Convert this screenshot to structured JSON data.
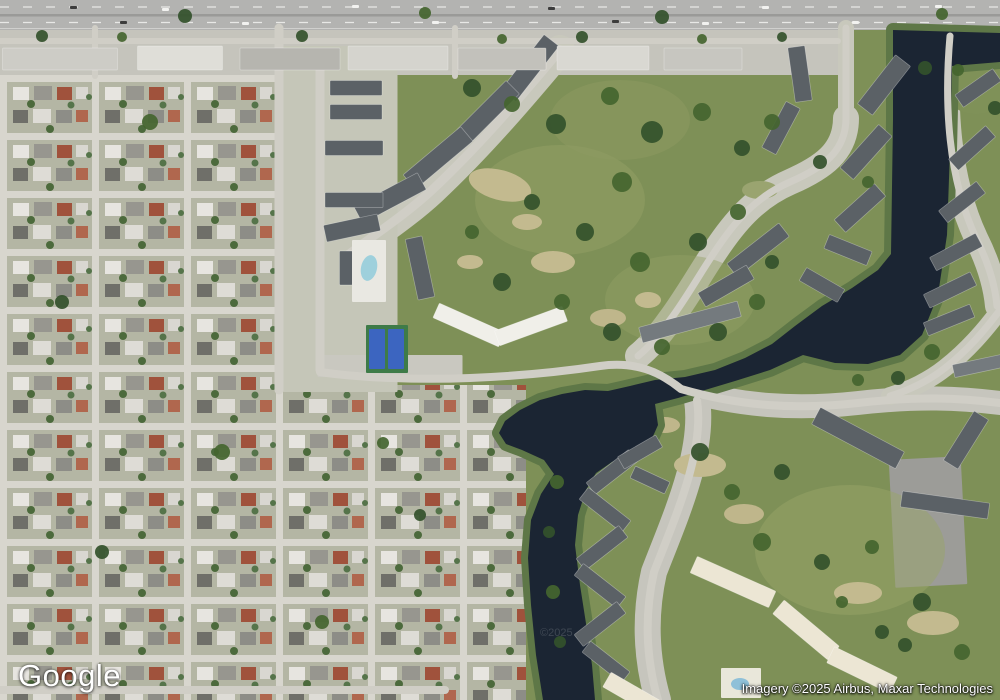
{
  "map": {
    "view_type": "satellite",
    "logo": "Google",
    "attribution": "Imagery ©2025 Airbus, Maxar Technologies",
    "watermark": "©2025"
  },
  "palette": {
    "water": "#1b2533",
    "bank": "#5e7747",
    "green": "#7e9057",
    "suburb_lawn": "#b4b6a4",
    "street": "#d8d6ce",
    "road": "#d0cec6",
    "ground": "#c8c8bc",
    "highway": "#b3b3b1",
    "parking": "#9c9c98",
    "tan_patch": "#c3ba8f",
    "court_green": "#3e7b48",
    "court_blue": "#3c65c0",
    "pool_blue": "#9ed0dc",
    "tree1": "#33512b",
    "tree2": "#44652f",
    "roofs": {
      "dark": "#5b6166",
      "mid": "#747a7e",
      "cream": "#ece6d4",
      "white": "#f0efe9",
      "light": "#cfcec8"
    }
  },
  "features": {
    "water_path": "M893,30 L1000,33 L1000,62 L952,66 L950,150 L947,235 L938,295 L922,335 L900,355 L868,364 L835,363 L803,355 L770,370 L735,381 L705,390 L678,398 L655,404 L658,425 L650,443 L632,453 L612,462 L596,473 L586,490 L578,515 L575,545 L580,585 L587,630 L592,665 L595,700 L543,700 L536,655 L531,605 L528,558 L531,520 L541,494 L554,474 L544,460 L522,450 L506,444 L499,433 L505,421 L520,410 L540,400 L562,394 L585,390 L608,391 L630,386 L655,380 L685,377 L715,370 L745,358 L772,344 L795,326 L822,306 L852,288 L878,270 L891,254 L893,120 Z",
    "ground_paths": [
      [
        "M560,50 C525,92 480,145 432,190 C404,216 372,236 344,258",
        30,
        "#c8c8bc"
      ],
      [
        "M846,28 L846,118",
        16,
        "#c8c8bc"
      ],
      [
        "M846,118 C846,152 822,168 790,182 C758,196 738,218 720,244 C703,268 688,296 670,320 C658,337 648,348 638,356",
        26,
        "#c8c8bc"
      ],
      [
        "M950,36 C944,104 948,178 976,238 C988,262 995,284 997,306",
        24,
        "#c8c8bc"
      ],
      [
        "M681,389 C740,406 795,410 858,403 C918,396 960,398 1000,403",
        24,
        "#c6c5bd"
      ],
      [
        "M697,400 C705,452 674,520 654,572 C645,612 645,655 658,700",
        26,
        "#c6c5bd"
      ],
      [
        "M1000,310 C985,330 968,350 945,368 C930,380 910,390 890,396",
        18,
        "#c8c8bc"
      ]
    ],
    "ground_rects": [
      [
        340,
        219,
        115,
        346,
        0,
        "#c5c6b8"
      ],
      [
        928,
        522,
        72,
        128,
        -3,
        "#9c9c98"
      ],
      [
        390,
        366,
        145,
        22,
        0,
        "#c9c8c0"
      ]
    ],
    "ground_ellipses": [
      [
        976,
        86,
        34,
        28,
        0,
        "#7f9158",
        1
      ],
      [
        560,
        200,
        85,
        55,
        0,
        "#93a065",
        0.5
      ],
      [
        680,
        300,
        75,
        45,
        0,
        "#93a065",
        0.45
      ],
      [
        850,
        550,
        95,
        65,
        0,
        "#98a468",
        0.5
      ],
      [
        620,
        120,
        70,
        40,
        0,
        "#8d9a62",
        0.5
      ],
      [
        500,
        185,
        32,
        15,
        15,
        "#c3ba8f",
        1
      ],
      [
        553,
        262,
        22,
        11,
        0,
        "#c3ba8f",
        1
      ],
      [
        608,
        318,
        18,
        9,
        0,
        "#bfb68b",
        1
      ],
      [
        648,
        300,
        13,
        8,
        0,
        "#c3ba8f",
        1
      ],
      [
        700,
        465,
        26,
        12,
        0,
        "#c3ba8f",
        1
      ],
      [
        744,
        514,
        20,
        10,
        0,
        "#bfb68b",
        1
      ],
      [
        858,
        593,
        24,
        11,
        0,
        "#c3ba8f",
        1
      ],
      [
        933,
        623,
        26,
        12,
        0,
        "#c3ba8f",
        1
      ],
      [
        665,
        425,
        15,
        8,
        0,
        "#bfb68b",
        1
      ],
      [
        470,
        262,
        13,
        7,
        0,
        "#c3ba8f",
        1
      ],
      [
        527,
        222,
        15,
        8,
        0,
        "#c3ba8f",
        1
      ],
      [
        760,
        190,
        18,
        9,
        0,
        "#9aa470",
        1
      ]
    ],
    "roads": [
      [
        "M0,41 L838,41",
        6
      ],
      [
        "M279,28 L279,390",
        9
      ],
      [
        "M95,28 L95,76",
        6
      ],
      [
        "M455,28 L455,76",
        6
      ],
      [
        "M846,28 L846,118",
        7
      ],
      [
        "M846,118 C846,152 822,168 790,182 C758,196 738,218 720,244 C703,268 688,296 670,320 C658,337 648,348 638,356",
        7
      ],
      [
        "M950,36 C944,104 948,178 976,238 C988,262 995,284 997,306",
        7
      ],
      [
        "M320,60 L320,370",
        9
      ],
      [
        "M560,50 C525,92 480,145 432,190 C404,216 372,236 344,258",
        9
      ],
      [
        "M320,372 C360,378 420,380 470,378 C520,376 560,372 600,366 C636,361 660,372 681,389",
        8
      ],
      [
        "M681,389 C740,406 795,410 858,403 C918,396 960,398 1000,403",
        8
      ],
      [
        "M697,400 C705,452 674,520 654,572 C645,612 645,655 658,700",
        8
      ],
      [
        "M1000,310 C985,330 968,350 945,368 C930,380 910,390 890,396",
        7
      ],
      [
        "M0,690 L445,690",
        8
      ]
    ],
    "buildings": [
      [
        530,
        68,
        70,
        19,
        -52,
        "dark"
      ],
      [
        488,
        112,
        70,
        19,
        -45,
        "dark"
      ],
      [
        438,
        158,
        75,
        19,
        -40,
        "dark"
      ],
      [
        390,
        198,
        72,
        19,
        -28,
        "dark"
      ],
      [
        352,
        228,
        55,
        17,
        -12,
        "dark"
      ],
      [
        356,
        88,
        52,
        15,
        0,
        "dark"
      ],
      [
        356,
        112,
        52,
        15,
        0,
        "dark"
      ],
      [
        354,
        148,
        58,
        15,
        0,
        "dark"
      ],
      [
        354,
        200,
        58,
        15,
        0,
        "dark"
      ],
      [
        420,
        268,
        62,
        17,
        78,
        "dark"
      ],
      [
        346,
        268,
        13,
        34,
        0,
        "dark"
      ],
      [
        469,
        325,
        72,
        16,
        24,
        "white"
      ],
      [
        531,
        326,
        72,
        16,
        -20,
        "white"
      ],
      [
        800,
        74,
        55,
        17,
        82,
        "dark"
      ],
      [
        781,
        128,
        52,
        16,
        -62,
        "dark"
      ],
      [
        758,
        250,
        66,
        17,
        -38,
        "dark"
      ],
      [
        726,
        286,
        56,
        16,
        -30,
        "dark"
      ],
      [
        690,
        322,
        102,
        16,
        -15,
        "mid"
      ],
      [
        884,
        85,
        62,
        19,
        -52,
        "dark"
      ],
      [
        866,
        152,
        58,
        18,
        -48,
        "dark"
      ],
      [
        860,
        208,
        54,
        17,
        -42,
        "dark"
      ],
      [
        848,
        250,
        46,
        15,
        22,
        "dark"
      ],
      [
        822,
        285,
        44,
        15,
        30,
        "dark"
      ],
      [
        978,
        88,
        46,
        15,
        -35,
        "dark"
      ],
      [
        972,
        148,
        50,
        15,
        -42,
        "dark"
      ],
      [
        962,
        202,
        48,
        15,
        -38,
        "dark"
      ],
      [
        956,
        252,
        52,
        15,
        -28,
        "dark"
      ],
      [
        950,
        290,
        52,
        15,
        -26,
        "dark"
      ],
      [
        949,
        320,
        50,
        14,
        -22,
        "dark"
      ],
      [
        978,
        366,
        50,
        13,
        -12,
        "mid"
      ],
      [
        858,
        438,
        95,
        19,
        28,
        "dark"
      ],
      [
        966,
        440,
        58,
        17,
        -58,
        "dark"
      ],
      [
        945,
        505,
        88,
        16,
        8,
        "dark"
      ],
      [
        612,
        472,
        54,
        15,
        -38,
        "dark"
      ],
      [
        605,
        510,
        54,
        15,
        38,
        "dark"
      ],
      [
        602,
        548,
        54,
        15,
        -38,
        "dark"
      ],
      [
        600,
        586,
        54,
        15,
        38,
        "dark"
      ],
      [
        600,
        624,
        54,
        15,
        -38,
        "dark"
      ],
      [
        606,
        662,
        50,
        14,
        38,
        "dark"
      ],
      [
        640,
        452,
        44,
        14,
        -30,
        "dark"
      ],
      [
        650,
        480,
        38,
        13,
        25,
        "dark"
      ],
      [
        733,
        582,
        86,
        18,
        24,
        "cream"
      ],
      [
        806,
        630,
        72,
        18,
        40,
        "cream"
      ],
      [
        862,
        670,
        70,
        18,
        26,
        "cream"
      ],
      [
        632,
        694,
        58,
        17,
        30,
        "cream"
      ],
      [
        60,
        59,
        115,
        22,
        0,
        "#cdccc6"
      ],
      [
        180,
        58,
        85,
        24,
        0,
        "#dfded8"
      ],
      [
        290,
        59,
        100,
        22,
        0,
        "#b6b5af"
      ],
      [
        398,
        58,
        100,
        24,
        0,
        "#d5d4ce"
      ],
      [
        502,
        59,
        88,
        22,
        0,
        "#c2c1bb"
      ],
      [
        603,
        58,
        92,
        24,
        0,
        "#d9d8d2"
      ],
      [
        703,
        59,
        78,
        22,
        0,
        "#c7c6c0"
      ]
    ],
    "amenity_rects": [
      [
        387,
        349,
        42,
        48,
        0,
        "#3e7b48"
      ],
      [
        377,
        349,
        16,
        40,
        0,
        "#3c65c0"
      ],
      [
        396,
        349,
        16,
        40,
        0,
        "#3c65c0"
      ],
      [
        369,
        271,
        34,
        62,
        0,
        "#e9e8e2"
      ],
      [
        741,
        683,
        40,
        30,
        0,
        "#e9e7da"
      ]
    ],
    "amenity_ellipses": [
      [
        369,
        268,
        8,
        13,
        12,
        "#9ed0dc",
        1
      ],
      [
        740,
        684,
        9,
        6,
        0,
        "#8fc0d8",
        1
      ]
    ],
    "trees": [
      [
        472,
        88,
        9
      ],
      [
        512,
        104,
        8
      ],
      [
        556,
        124,
        10
      ],
      [
        610,
        96,
        9
      ],
      [
        652,
        132,
        11
      ],
      [
        702,
        112,
        9
      ],
      [
        742,
        148,
        8
      ],
      [
        622,
        182,
        10
      ],
      [
        585,
        232,
        9
      ],
      [
        640,
        262,
        10
      ],
      [
        698,
        242,
        9
      ],
      [
        738,
        212,
        8
      ],
      [
        532,
        202,
        8
      ],
      [
        472,
        232,
        7
      ],
      [
        502,
        282,
        9
      ],
      [
        562,
        302,
        8
      ],
      [
        612,
        332,
        9
      ],
      [
        662,
        347,
        8
      ],
      [
        718,
        332,
        9
      ],
      [
        757,
        302,
        8
      ],
      [
        772,
        262,
        7
      ],
      [
        772,
        122,
        8
      ],
      [
        820,
        162,
        7
      ],
      [
        868,
        182,
        6
      ],
      [
        925,
        68,
        7
      ],
      [
        958,
        70,
        6
      ],
      [
        995,
        108,
        7
      ],
      [
        932,
        352,
        8
      ],
      [
        898,
        378,
        7
      ],
      [
        858,
        380,
        6
      ],
      [
        700,
        452,
        9
      ],
      [
        732,
        492,
        8
      ],
      [
        782,
        472,
        8
      ],
      [
        762,
        542,
        9
      ],
      [
        822,
        562,
        8
      ],
      [
        872,
        547,
        7
      ],
      [
        922,
        602,
        9
      ],
      [
        962,
        652,
        8
      ],
      [
        882,
        632,
        7
      ],
      [
        842,
        602,
        6
      ],
      [
        905,
        645,
        7
      ],
      [
        557,
        482,
        7
      ],
      [
        549,
        532,
        6
      ],
      [
        553,
        592,
        7
      ],
      [
        560,
        642,
        6
      ],
      [
        150,
        122,
        8
      ],
      [
        62,
        302,
        7
      ],
      [
        222,
        452,
        8
      ],
      [
        102,
        552,
        7
      ],
      [
        322,
        622,
        7
      ],
      [
        420,
        515,
        6
      ],
      [
        383,
        443,
        6
      ],
      [
        185,
        16,
        7
      ],
      [
        425,
        13,
        6
      ],
      [
        662,
        17,
        7
      ],
      [
        942,
        14,
        6
      ],
      [
        42,
        36,
        6
      ],
      [
        122,
        37,
        5
      ],
      [
        302,
        36,
        6
      ],
      [
        502,
        39,
        5
      ],
      [
        582,
        37,
        6
      ],
      [
        702,
        39,
        5
      ],
      [
        782,
        37,
        5
      ]
    ],
    "vehicles": [
      [
        70,
        6
      ],
      [
        162,
        8
      ],
      [
        352,
        5
      ],
      [
        548,
        7
      ],
      [
        762,
        6
      ],
      [
        935,
        5
      ],
      [
        120,
        21
      ],
      [
        242,
        22
      ],
      [
        432,
        21
      ],
      [
        612,
        20
      ],
      [
        702,
        22
      ],
      [
        852,
        21
      ]
    ]
  }
}
